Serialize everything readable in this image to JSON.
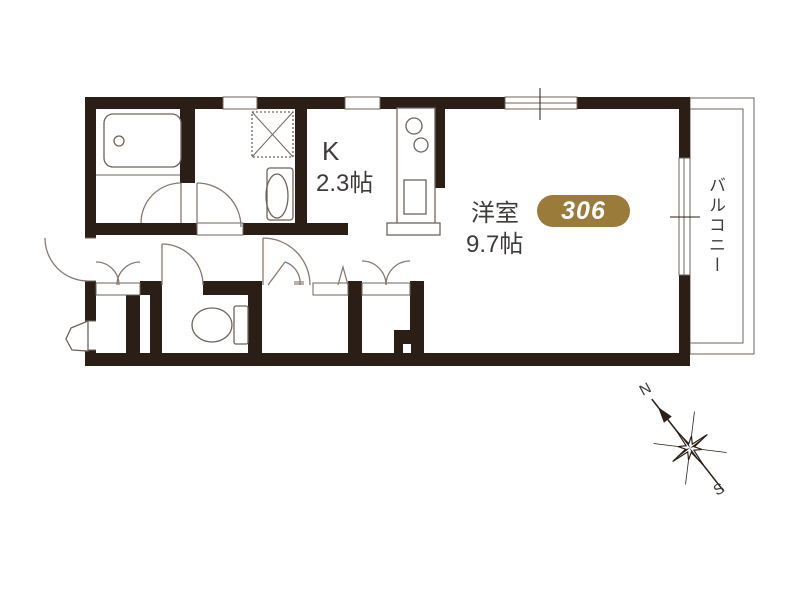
{
  "floorplan": {
    "unit_badge": {
      "number": "306",
      "color": "#9a7b3a"
    },
    "kitchen": {
      "label": "K",
      "size": "2.3帖"
    },
    "western_room": {
      "label": "洋室",
      "size": "9.7帖"
    },
    "balcony": {
      "label": "バルコニー"
    },
    "compass": {
      "north": "N",
      "south": "S"
    },
    "colors": {
      "wall": "#2b1e16",
      "fixture_line": "#6f635b",
      "text": "#3f3b3a",
      "badge_text": "#ffffff"
    },
    "fixture_icons": [
      "bathtub-icon",
      "washing-machine-pan-icon",
      "washbasin-icon",
      "kitchen-counter-icon",
      "burner-icon",
      "kitchen-sink-icon",
      "toilet-icon",
      "door-swing-icon",
      "closet-double-door-icon",
      "folding-door-icon",
      "entrance-door-icon",
      "sliding-window-icon",
      "pipe-space-pillar",
      "compass-rose-icon"
    ]
  }
}
